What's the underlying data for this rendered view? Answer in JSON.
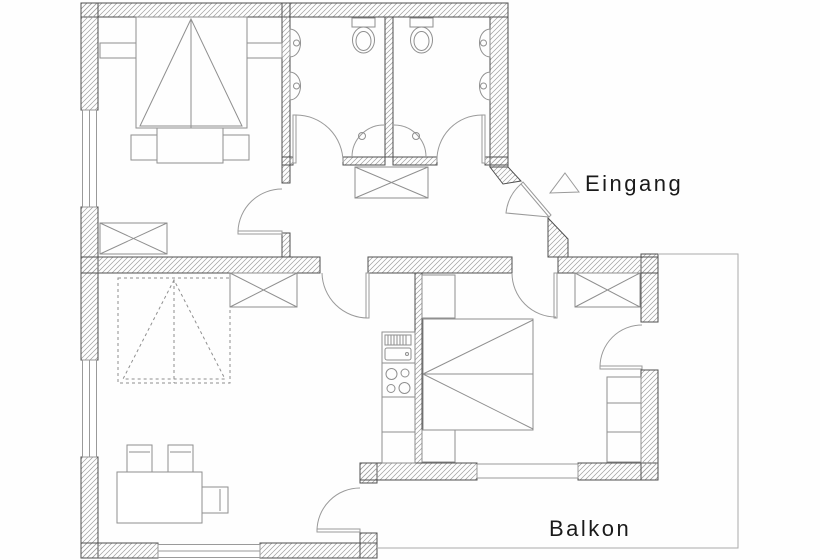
{
  "labels": {
    "entrance": "Eingang",
    "balcony": "Balkon"
  },
  "icons": {
    "entrance_marker": "triangle-outline-icon"
  },
  "colors": {
    "background": "#fefefe",
    "wall_outline": "#4f4f4f",
    "hatch_line": "#9e9e9e",
    "furniture_line": "#8f8f8f",
    "door_line": "#9a9a9a",
    "label_text": "#1a1a1a"
  }
}
